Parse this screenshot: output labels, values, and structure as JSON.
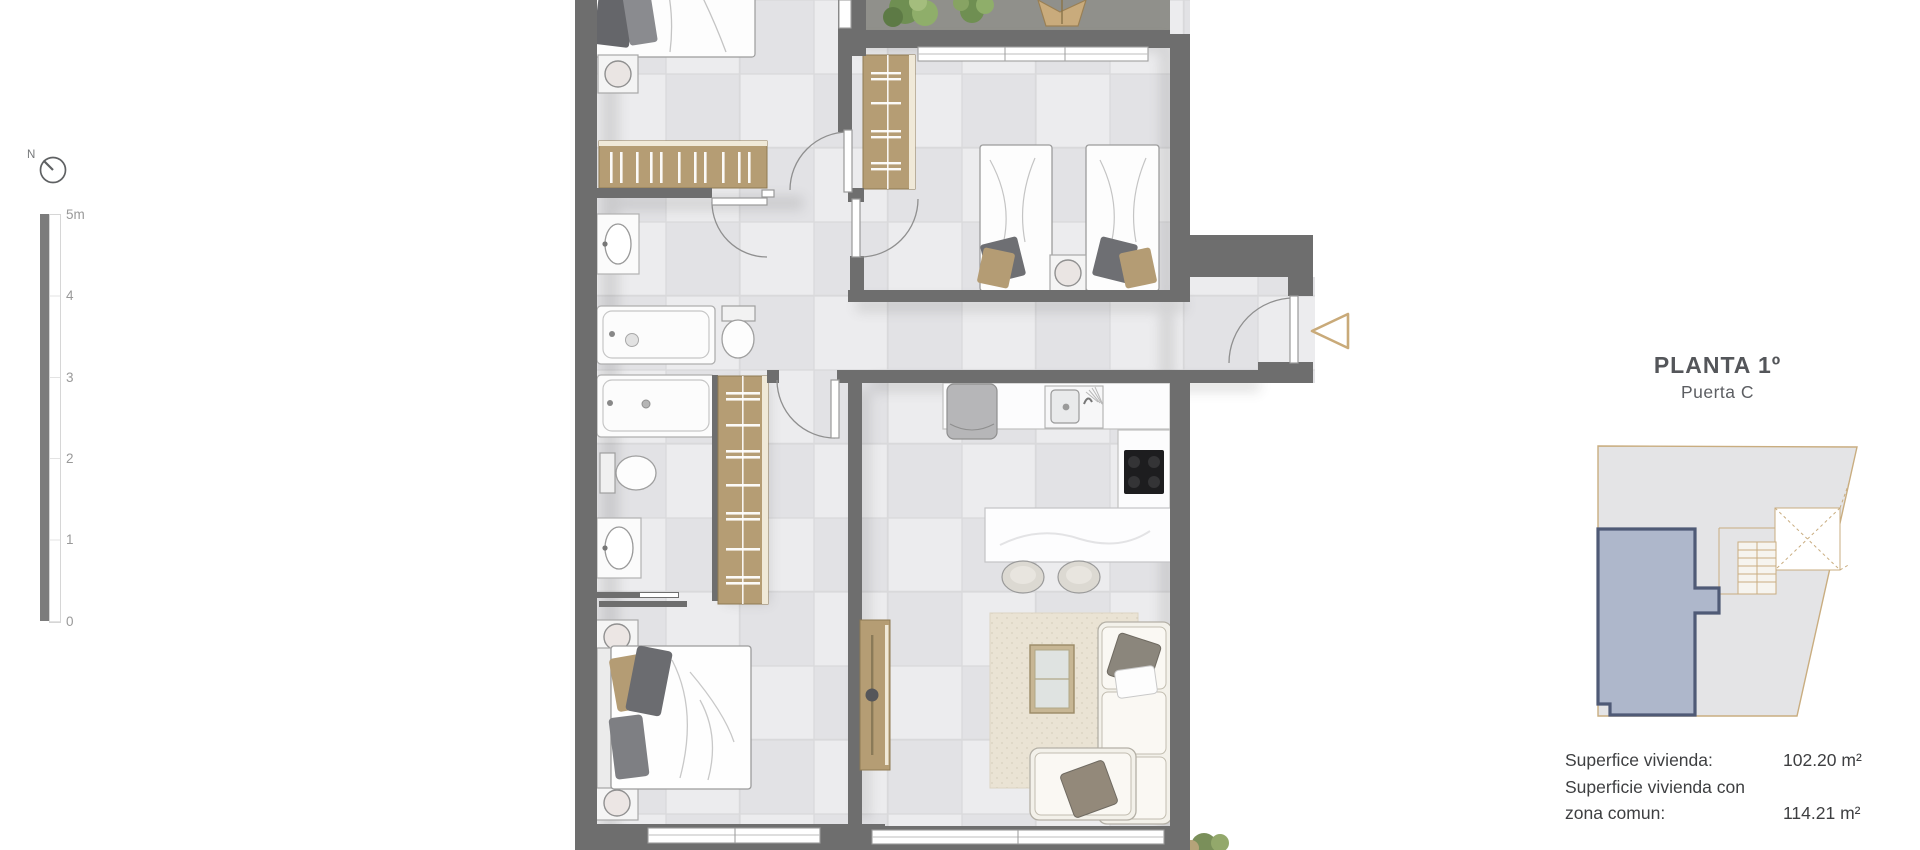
{
  "palette": {
    "wall": "#6e6e6e",
    "floor-a": "#ececee",
    "floor-b": "#e2e2e5",
    "grid": "#d9d9db",
    "terrace": "#90908b",
    "wood": "#b59d74",
    "wood-dark": "#8f7a53",
    "rug": "#eae3d4",
    "accent-arrow": "#c9aa79",
    "unit-fill": "#a9b3c9",
    "unit-stroke": "#4f5a76",
    "keyplan-fill": "#e4e4e6",
    "keyplan-stroke": "#c9ad80",
    "title": "#54565a",
    "body-text": "#3e3f41",
    "scale-text": "#999999",
    "bar": "#7c7c7c"
  },
  "compass": {
    "label": "N"
  },
  "scalebar": {
    "labels": [
      "5m",
      "4",
      "3",
      "2",
      "1",
      "0"
    ]
  },
  "panel": {
    "title": "PLANTA 1º",
    "subtitle": "Puerta C",
    "stats": [
      {
        "label": "Superfice vivienda:",
        "value": "102.20 m²"
      },
      {
        "label": "Superficie vivienda con",
        "label2": "zona comun:",
        "value": "114.21 m²"
      }
    ]
  }
}
